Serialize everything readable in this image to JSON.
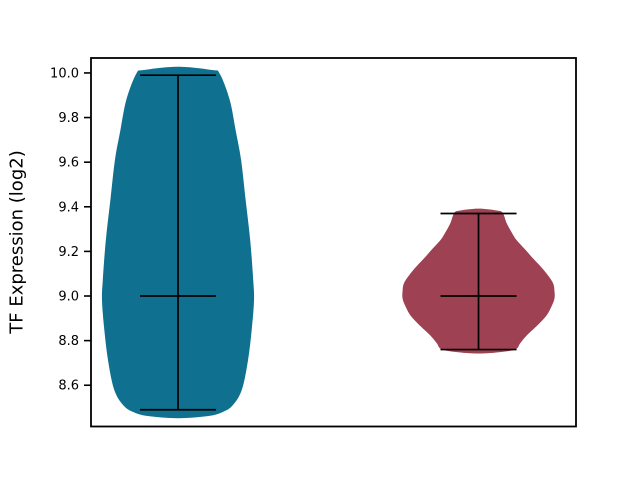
{
  "figure": {
    "title": "",
    "background_color": "#ffffff"
  },
  "chart_data": {
    "type": "violin",
    "title": "",
    "xlabel": "",
    "ylabel": "TF Expression (log2)",
    "ylim": [
      8.415,
      10.067
    ],
    "yticks": [
      8.6,
      8.8,
      9.0,
      9.2,
      9.4,
      9.6,
      9.8,
      10.0
    ],
    "ytick_decimals": 1,
    "xticklabels": [],
    "grid": false,
    "legend": false,
    "colors": {
      "axis": "#000000",
      "text": "#000000",
      "stat_lines": "#000000",
      "violin_left": "#10708F",
      "violin_right": "#9E4152"
    },
    "cap_halfwidth_frac": 0.0784,
    "series": [
      {
        "name": "left-violin",
        "color": "#10708F",
        "x_frac": 0.1794,
        "max_halfwidth_frac": 0.1567,
        "whisker_min": 8.49,
        "whisker_max": 9.99,
        "median": 9.0,
        "kde_support": [
          8.452,
          10.028
        ],
        "profile": [
          [
            10.028,
            0.0
          ],
          [
            10.013,
            0.45
          ],
          [
            9.996,
            0.55
          ],
          [
            9.88,
            0.68
          ],
          [
            9.74,
            0.76
          ],
          [
            9.61,
            0.83
          ],
          [
            9.43,
            0.89
          ],
          [
            9.25,
            0.95
          ],
          [
            9.07,
            0.99
          ],
          [
            8.98,
            1.0
          ],
          [
            8.85,
            0.97
          ],
          [
            8.71,
            0.92
          ],
          [
            8.58,
            0.84
          ],
          [
            8.51,
            0.72
          ],
          [
            8.48,
            0.59
          ],
          [
            8.462,
            0.4
          ],
          [
            8.452,
            0.0
          ]
        ]
      },
      {
        "name": "right-violin",
        "color": "#9E4152",
        "x_frac": 0.799,
        "max_halfwidth_frac": 0.1567,
        "whisker_min": 8.76,
        "whisker_max": 9.37,
        "median": 9.0,
        "kde_support": [
          8.742,
          9.392
        ],
        "profile": [
          [
            9.392,
            0.0
          ],
          [
            9.383,
            0.25
          ],
          [
            9.372,
            0.32
          ],
          [
            9.327,
            0.37
          ],
          [
            9.283,
            0.44
          ],
          [
            9.251,
            0.5
          ],
          [
            9.206,
            0.62
          ],
          [
            9.175,
            0.7
          ],
          [
            9.139,
            0.8
          ],
          [
            9.103,
            0.89
          ],
          [
            9.058,
            0.98
          ],
          [
            9.02,
            1.0
          ],
          [
            8.99,
            1.0
          ],
          [
            8.96,
            0.97
          ],
          [
            8.915,
            0.9
          ],
          [
            8.87,
            0.78
          ],
          [
            8.825,
            0.64
          ],
          [
            8.789,
            0.55
          ],
          [
            8.762,
            0.49
          ],
          [
            8.749,
            0.3
          ],
          [
            8.742,
            0.0
          ]
        ]
      }
    ]
  }
}
